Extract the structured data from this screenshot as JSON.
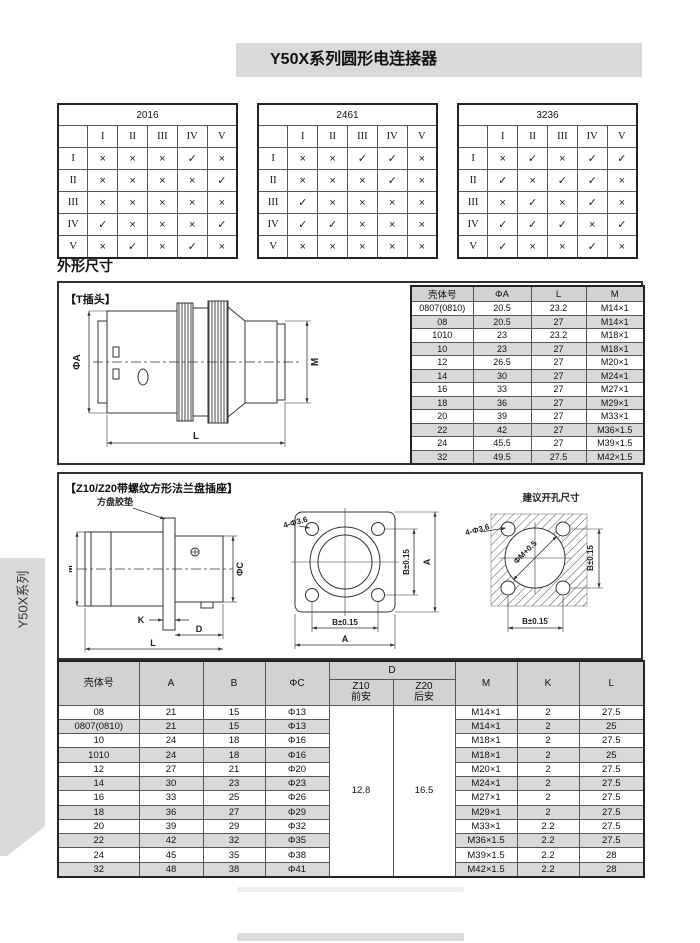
{
  "page": {
    "title": "Y50X系列圆形电连接器",
    "side_tab": "Y50X系列",
    "section_heading": "外形尺寸"
  },
  "matrices": [
    {
      "title": "2016",
      "col_headers": [
        "I",
        "II",
        "III",
        "IV",
        "V"
      ],
      "row_headers": [
        "I",
        "II",
        "III",
        "IV",
        "V"
      ],
      "cells": [
        [
          "×",
          "×",
          "×",
          "✓",
          "×"
        ],
        [
          "×",
          "×",
          "×",
          "×",
          "✓"
        ],
        [
          "×",
          "×",
          "×",
          "×",
          "×"
        ],
        [
          "✓",
          "×",
          "×",
          "×",
          "✓"
        ],
        [
          "×",
          "✓",
          "×",
          "✓",
          "×"
        ]
      ]
    },
    {
      "title": "2461",
      "col_headers": [
        "I",
        "II",
        "III",
        "IV",
        "V"
      ],
      "row_headers": [
        "I",
        "II",
        "III",
        "IV",
        "V"
      ],
      "cells": [
        [
          "×",
          "×",
          "✓",
          "✓",
          "×"
        ],
        [
          "×",
          "×",
          "×",
          "✓",
          "×"
        ],
        [
          "✓",
          "×",
          "×",
          "×",
          "×"
        ],
        [
          "✓",
          "✓",
          "×",
          "×",
          "×"
        ],
        [
          "×",
          "×",
          "×",
          "×",
          "×"
        ]
      ]
    },
    {
      "title": "3236",
      "col_headers": [
        "I",
        "II",
        "III",
        "IV",
        "V"
      ],
      "row_headers": [
        "I",
        "II",
        "III",
        "IV",
        "V"
      ],
      "cells": [
        [
          "×",
          "✓",
          "×",
          "✓",
          "✓"
        ],
        [
          "✓",
          "×",
          "✓",
          "✓",
          "×"
        ],
        [
          "×",
          "✓",
          "×",
          "✓",
          "×"
        ],
        [
          "✓",
          "✓",
          "✓",
          "×",
          "✓"
        ],
        [
          "✓",
          "×",
          "×",
          "✓",
          "×"
        ]
      ]
    }
  ],
  "t_plug": {
    "label": "【T插头】",
    "drawing": {
      "dia": "ΦA",
      "thread": "M",
      "length": "L"
    },
    "table": {
      "headers": [
        "壳体号",
        "ΦA",
        "L",
        "M"
      ],
      "rows": [
        [
          "0807(0810)",
          "20.5",
          "23.2",
          "M14×1"
        ],
        [
          "08",
          "20.5",
          "27",
          "M14×1"
        ],
        [
          "1010",
          "23",
          "23.2",
          "M18×1"
        ],
        [
          "10",
          "23",
          "27",
          "M18×1"
        ],
        [
          "12",
          "26.5",
          "27",
          "M20×1"
        ],
        [
          "14",
          "30",
          "27",
          "M24×1"
        ],
        [
          "16",
          "33",
          "27",
          "M27×1"
        ],
        [
          "18",
          "36",
          "27",
          "M29×1"
        ],
        [
          "20",
          "39",
          "27",
          "M33×1"
        ],
        [
          "22",
          "42",
          "27",
          "M36×1.5"
        ],
        [
          "24",
          "45.5",
          "27",
          "M39×1.5"
        ],
        [
          "32",
          "49.5",
          "27.5",
          "M42×1.5"
        ]
      ]
    }
  },
  "z_socket": {
    "label": "【Z10/Z20带螺纹方形法兰盘插座】",
    "side_drawing": {
      "gasket": "方盘胶垫",
      "m": "M",
      "c": "ΦC",
      "k": "K",
      "d": "D",
      "l": "L"
    },
    "front_drawing": {
      "holes": "4-Φ3.6",
      "b": "B±0.15",
      "a": "A"
    },
    "cutout_drawing": {
      "title": "建议开孔尺寸",
      "holes": "4-Φ3.6",
      "m": "ΦM+0.5",
      "b": "B±0.15"
    },
    "table": {
      "cols_left": [
        "壳体号",
        "A",
        "B",
        "ΦC"
      ],
      "d_col": "D",
      "d_sub": [
        [
          "Z10",
          "前安"
        ],
        [
          "Z20",
          "后安"
        ]
      ],
      "cols_right": [
        "M",
        "K",
        "L"
      ],
      "d_values": [
        "12.8",
        "16.5"
      ],
      "rows": [
        [
          "08",
          "21",
          "15",
          "Φ13",
          "M14×1",
          "2",
          "27.5"
        ],
        [
          "0807(0810)",
          "21",
          "15",
          "Φ13",
          "M14×1",
          "2",
          "25"
        ],
        [
          "10",
          "24",
          "18",
          "Φ16",
          "M18×1",
          "2",
          "27.5"
        ],
        [
          "1010",
          "24",
          "18",
          "Φ16",
          "M18×1",
          "2",
          "25"
        ],
        [
          "12",
          "27",
          "21",
          "Φ20",
          "M20×1",
          "2",
          "27.5"
        ],
        [
          "14",
          "30",
          "23",
          "Φ23",
          "M24×1",
          "2",
          "27.5"
        ],
        [
          "16",
          "33",
          "25",
          "Φ26",
          "M27×1",
          "2",
          "27.5"
        ],
        [
          "18",
          "36",
          "27",
          "Φ29",
          "M29×1",
          "2",
          "27.5"
        ],
        [
          "20",
          "39",
          "29",
          "Φ32",
          "M33×1",
          "2.2",
          "27.5"
        ],
        [
          "22",
          "42",
          "32",
          "Φ35",
          "M36×1.5",
          "2.2",
          "27.5"
        ],
        [
          "24",
          "45",
          "35",
          "Φ38",
          "M39×1.5",
          "2.2",
          "28"
        ],
        [
          "32",
          "48",
          "38",
          "Φ41",
          "M42×1.5",
          "2.2",
          "28"
        ]
      ]
    }
  }
}
